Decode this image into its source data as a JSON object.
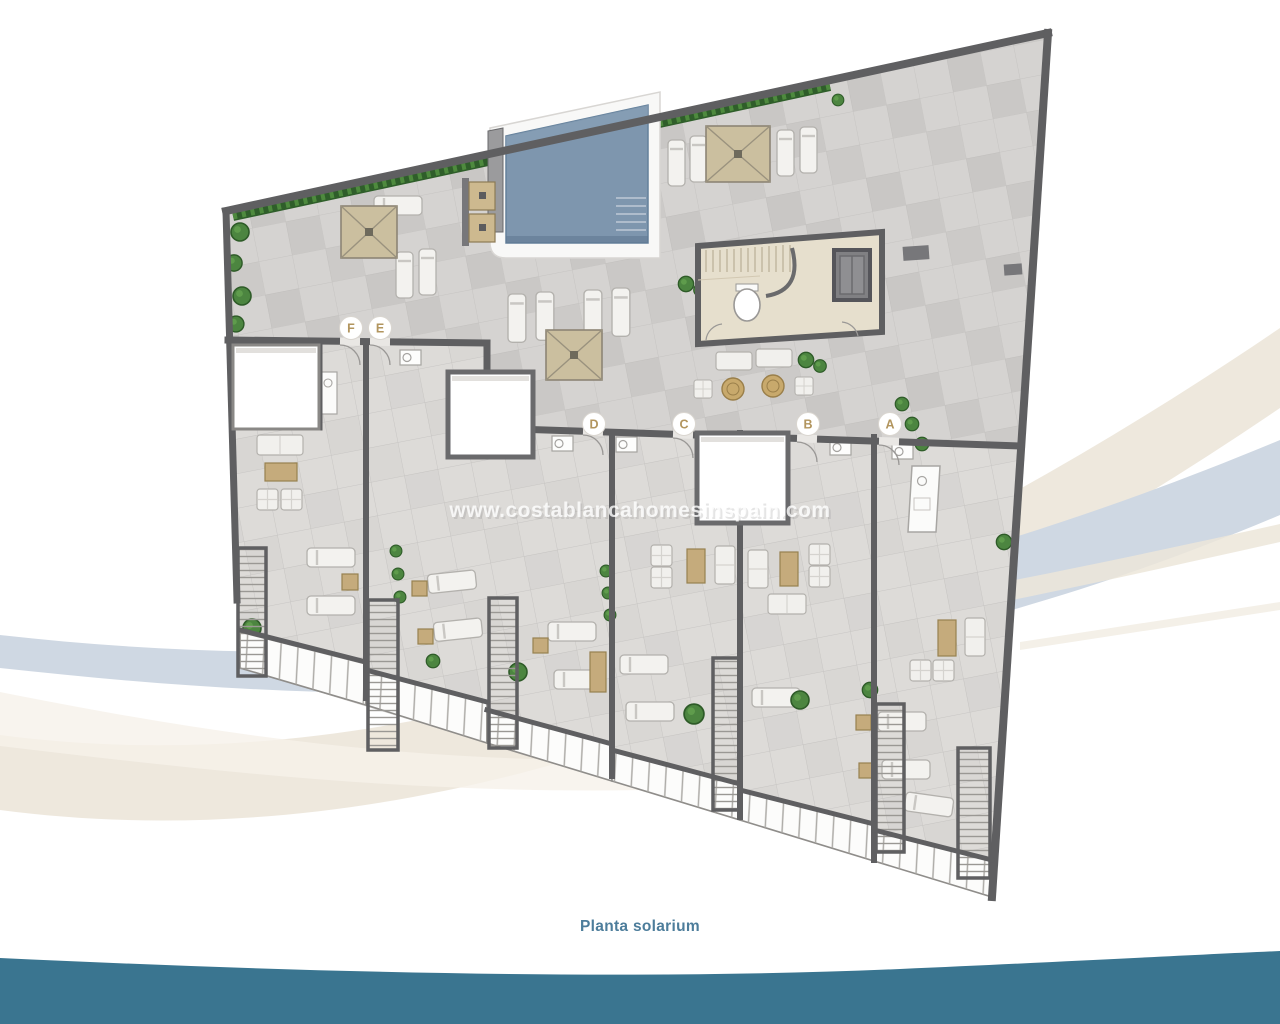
{
  "page": {
    "caption": "Planta solarium",
    "watermark": "www.costablancahomesinspain.com"
  },
  "plan": {
    "unit_labels": [
      {
        "label": "F",
        "x": 351,
        "y": 328
      },
      {
        "label": "E",
        "x": 380,
        "y": 328
      },
      {
        "label": "D",
        "x": 594,
        "y": 424
      },
      {
        "label": "C",
        "x": 684,
        "y": 424
      },
      {
        "label": "B",
        "x": 808,
        "y": 424
      },
      {
        "label": "A",
        "x": 890,
        "y": 424
      }
    ],
    "features": [
      "swimming-pool",
      "pool-deck",
      "shower",
      "pergolas",
      "sun-loungers",
      "stair-block",
      "toilet",
      "elevator",
      "lounge-seating",
      "skylights",
      "private-terraces",
      "stairwells",
      "railings",
      "hedges",
      "planters"
    ],
    "colors": {
      "caption_text": "#4d7d9b",
      "label_letter": "#b2955e",
      "pool_water": "#7e96ae",
      "wall": "#5f5f61",
      "floor_common": "#cecccA",
      "floor_terrace": "#dddbd8",
      "pergola": "#cbbf9f",
      "hedge": "#3e6b34",
      "band_cream": "#ece6d9",
      "band_blue": "#cfd8e3",
      "bottom_wave": "#3a7590"
    }
  }
}
